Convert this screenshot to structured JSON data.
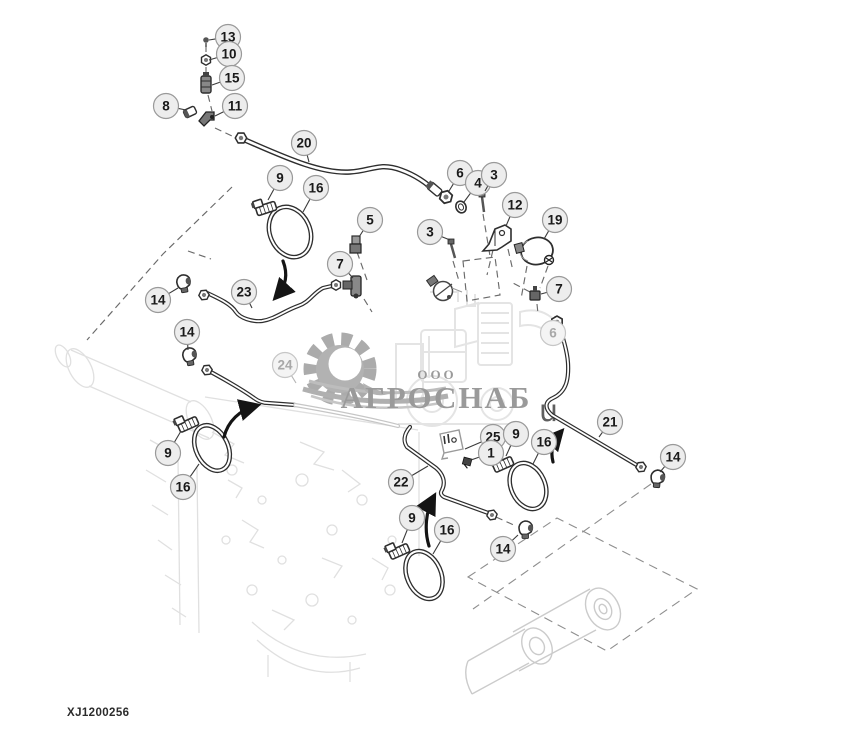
{
  "meta": {
    "drawing_code": "XJ1200256"
  },
  "watermark": {
    "company_type": "ООО",
    "company_name": "АГРОСНАБ",
    "stray_text": "u"
  },
  "colors": {
    "callout_fill": "#ededed",
    "callout_stroke": "#999999",
    "callout_text": "#1a1a1a",
    "callout_fill_faded": "#f4f4f4",
    "callout_stroke_faded": "#c6c6c6",
    "callout_text_faded": "#a8a8a8",
    "leader": "#3a3a3a",
    "leader_faded": "#b5b5b5"
  },
  "callouts": [
    {
      "label": "13",
      "x": 228,
      "y": 37,
      "tx": 209,
      "ty": 40
    },
    {
      "label": "10",
      "x": 229,
      "y": 54,
      "tx": 209,
      "ty": 60
    },
    {
      "label": "15",
      "x": 232,
      "y": 78,
      "tx": 212,
      "ty": 85
    },
    {
      "label": "8",
      "x": 166,
      "y": 106,
      "tx": 186,
      "ty": 110
    },
    {
      "label": "11",
      "x": 235,
      "y": 106,
      "tx": 215,
      "ty": 116
    },
    {
      "label": "20",
      "x": 304,
      "y": 143,
      "tx": 309,
      "ty": 162
    },
    {
      "label": "9",
      "x": 280,
      "y": 178,
      "tx": 268,
      "ty": 200
    },
    {
      "label": "16",
      "x": 316,
      "y": 188,
      "tx": 303,
      "ty": 212
    },
    {
      "label": "5",
      "x": 370,
      "y": 220,
      "tx": 359,
      "ty": 237
    },
    {
      "label": "6",
      "x": 460,
      "y": 173,
      "tx": 449,
      "ty": 191
    },
    {
      "label": "4",
      "x": 478,
      "y": 183,
      "tx": 464,
      "ty": 202
    },
    {
      "label": "3",
      "x": 494,
      "y": 175,
      "tx": 485,
      "ty": 191
    },
    {
      "label": "12",
      "x": 515,
      "y": 205,
      "tx": 506,
      "ty": 226
    },
    {
      "label": "19",
      "x": 555,
      "y": 220,
      "tx": 544,
      "ty": 239
    },
    {
      "label": "3",
      "x": 430,
      "y": 232,
      "tx": 450,
      "ty": 240
    },
    {
      "label": "7",
      "x": 340,
      "y": 264,
      "tx": 353,
      "ty": 278
    },
    {
      "label": "14",
      "x": 158,
      "y": 300,
      "tx": 178,
      "ty": 288
    },
    {
      "label": "23",
      "x": 244,
      "y": 292,
      "tx": 252,
      "ty": 308
    },
    {
      "label": "7",
      "x": 559,
      "y": 289,
      "tx": 541,
      "ty": 294
    },
    {
      "label": "6",
      "x": 553,
      "y": 333,
      "tx": 556,
      "ty": 325,
      "faded": true
    },
    {
      "label": "14",
      "x": 187,
      "y": 332,
      "tx": 188,
      "ty": 350
    },
    {
      "label": "24",
      "x": 285,
      "y": 365,
      "tx": 296,
      "ty": 383,
      "faded": true
    },
    {
      "label": "21",
      "x": 610,
      "y": 422,
      "tx": 599,
      "ty": 437
    },
    {
      "label": "25",
      "x": 493,
      "y": 437,
      "tx": 465,
      "ty": 449
    },
    {
      "label": "9",
      "x": 516,
      "y": 434,
      "tx": 506,
      "ty": 456
    },
    {
      "label": "16",
      "x": 544,
      "y": 442,
      "tx": 533,
      "ty": 464
    },
    {
      "label": "1",
      "x": 491,
      "y": 453,
      "tx": 471,
      "ty": 460
    },
    {
      "label": "14",
      "x": 673,
      "y": 457,
      "tx": 660,
      "ty": 472
    },
    {
      "label": "9",
      "x": 168,
      "y": 453,
      "tx": 181,
      "ty": 431
    },
    {
      "label": "16",
      "x": 183,
      "y": 487,
      "tx": 199,
      "ty": 464
    },
    {
      "label": "22",
      "x": 401,
      "y": 482,
      "tx": 428,
      "ty": 466
    },
    {
      "label": "9",
      "x": 412,
      "y": 518,
      "tx": 402,
      "ty": 543
    },
    {
      "label": "16",
      "x": 447,
      "y": 530,
      "tx": 433,
      "ty": 554
    },
    {
      "label": "14",
      "x": 503,
      "y": 549,
      "tx": 518,
      "ty": 535
    }
  ]
}
